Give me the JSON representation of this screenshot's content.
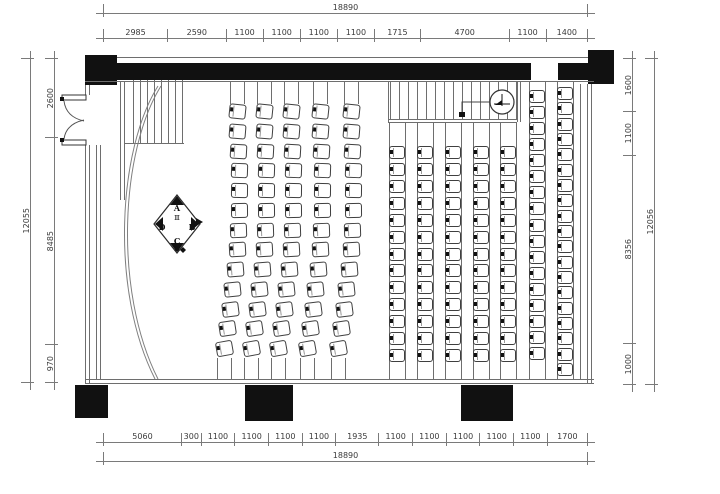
{
  "drawing": {
    "type": "cinema-seating-floor-plan"
  },
  "dimensions": {
    "top": {
      "overall": "18890",
      "segments": [
        "2985",
        "2590",
        "1100",
        "1100",
        "1100",
        "1100",
        "1715",
        "4700",
        "1100",
        "1400"
      ]
    },
    "bottom": {
      "overall": "18890",
      "segments": [
        "5060",
        "300",
        "1100",
        "1100",
        "1100",
        "1100",
        "1935",
        "1100",
        "1100",
        "1100",
        "1100",
        "1100",
        "1700"
      ]
    },
    "left": {
      "overall": "12055",
      "segments": [
        "2600",
        "8485",
        "970"
      ]
    },
    "right": {
      "overall": "12056",
      "segments": [
        "1600",
        "1100",
        "8356",
        "1000"
      ]
    }
  },
  "elevation_marker": {
    "top": "A",
    "right": "B",
    "bottom": "C",
    "left": "D",
    "glyph": "Ⅲ"
  },
  "seating": {
    "curved": {
      "rows": [
        {
          "x": 237
        },
        {
          "x": 264
        },
        {
          "x": 291
        },
        {
          "x": 320
        },
        {
          "x": 351
        }
      ],
      "top": 104,
      "bottom": 356,
      "count": 13,
      "drift": -13,
      "bulge": 8,
      "seat_w": 17,
      "seat_h": 15
    },
    "straight": {
      "rows": [
        {
          "x": 397,
          "top": 146,
          "bottom": 362,
          "count": 13,
          "rail_top": 123
        },
        {
          "x": 425,
          "top": 146,
          "bottom": 362,
          "count": 13,
          "rail_top": 123
        },
        {
          "x": 453,
          "top": 146,
          "bottom": 362,
          "count": 13,
          "rail_top": 123
        },
        {
          "x": 481,
          "top": 146,
          "bottom": 362,
          "count": 13,
          "rail_top": 123
        },
        {
          "x": 508,
          "top": 146,
          "bottom": 362,
          "count": 13,
          "rail_top": 123
        },
        {
          "x": 537,
          "top": 90,
          "bottom": 360,
          "count": 17,
          "rail_top": 82
        },
        {
          "x": 565,
          "top": 87,
          "bottom": 376,
          "count": 19,
          "rail_top": 82
        }
      ],
      "seat_w": 16,
      "seat_h": 13,
      "rail_bottom": 379
    }
  },
  "hatches": {
    "stairs": {
      "x": 133,
      "count": 8,
      "gap": 7,
      "y1": 80,
      "y2": 143
    },
    "steps": {
      "x": 390,
      "count": 15,
      "gap": 9,
      "y1": 82,
      "y2": 119
    }
  },
  "colors": {
    "wall": "#111111",
    "line": "#6e6e6e",
    "dim": "#7a7a7a",
    "text": "#3a3a3a"
  }
}
